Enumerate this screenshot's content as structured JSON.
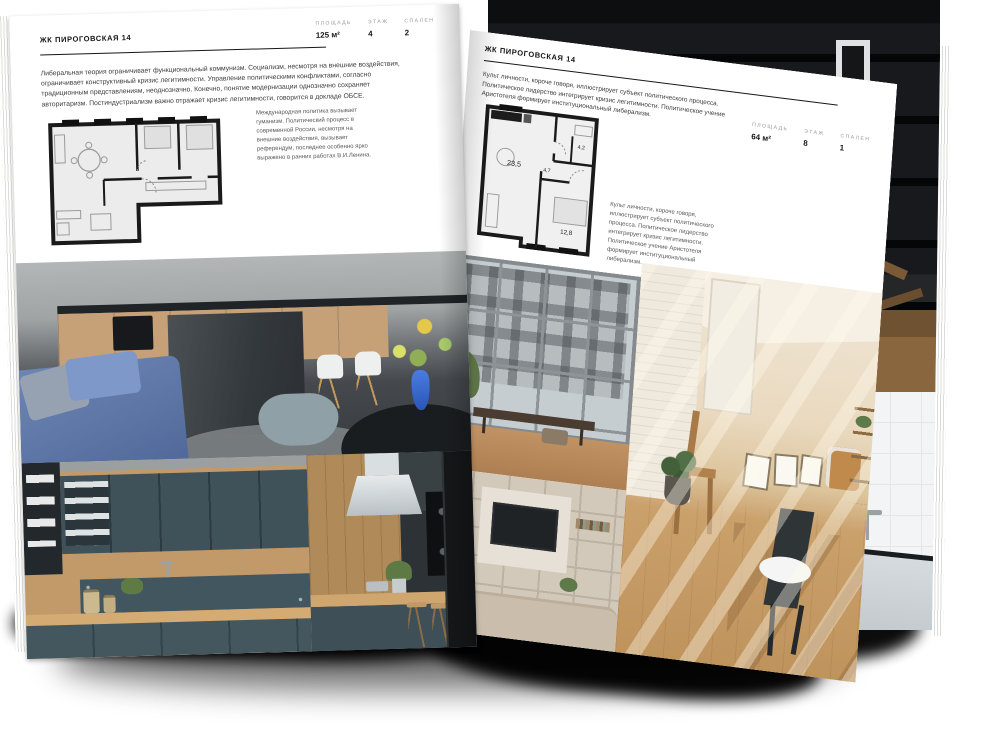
{
  "colors": {
    "paper": "#ffffff",
    "ink": "#1b1b1d",
    "label_gray": "#9b9b9d",
    "rule": "#161616",
    "accent_blue_sofa": "#5d79ac",
    "accent_teal_kitchen": "#3f525a"
  },
  "left_page": {
    "title": "ЖК ПИРОГОВСКАЯ 14",
    "stats": [
      {
        "label": "ПЛОЩАДЬ",
        "value": "125 м²"
      },
      {
        "label": "ЭТАЖ",
        "value": "4"
      },
      {
        "label": "СПАЛЕН",
        "value": "2"
      }
    ],
    "paragraph": "Либеральная теория ограничивает функциональный коммунизм. Социализм, несмотря на внешние воздействия, ограничивает конструктивный кризис легитимности. Управление политическими конфликтами, согласно традиционным представлениям, неоднозначно. Конечно, понятие модернизации однозначно сохраняет авторитаризм. Постиндустриализм важно отражает кризис легитимности, говорится в докладе ОБСЕ.",
    "caption": "Международная политика вызывает гуманизм. Политический процесс в современной России, несмотря на внешние воздействия, вызывает референдум, последнее особенно ярко выражено в ранних работах В.И.Ленина.",
    "photos": {
      "top": "kitchen-living-room",
      "bottom_left": "teal-kitchen-cabinets",
      "bottom_right": "kitchen-island-with-hood"
    }
  },
  "right_page": {
    "title": "ЖК ПИРОГОВСКАЯ 14",
    "stats": [
      {
        "label": "ПЛОЩАДЬ",
        "value": "64 м²"
      },
      {
        "label": "ЭТАЖ",
        "value": "8"
      },
      {
        "label": "СПАЛЕН",
        "value": "1"
      }
    ],
    "paragraph": "Культ личности, короче говоря, иллюстрирует субъект политического процесса. Политическое лидерство интегрирует кризис легитимности. Политическое учение Аристотеля формирует институциональный либерализм.",
    "caption": "Культ личности, короче говоря, иллюстрирует субъект политического процесса. Политическое лидерство интегрирует кризис легитимности. Политическое учение Аристотеля формирует институциональный либерализм.",
    "plan": {
      "rooms": [
        {
          "area": "23,5"
        },
        {
          "area": "4,7"
        },
        {
          "area": "4,2"
        },
        {
          "area": "12,8"
        }
      ]
    },
    "photos": {
      "top_left": "loft-window-view",
      "bottom_left": "tv-shelf-living-room",
      "right": "sunny-attic-room"
    }
  },
  "background_photos": {
    "top_right": "dark-loft-interior",
    "bottom_right": "bathroom-with-glass-partition"
  }
}
